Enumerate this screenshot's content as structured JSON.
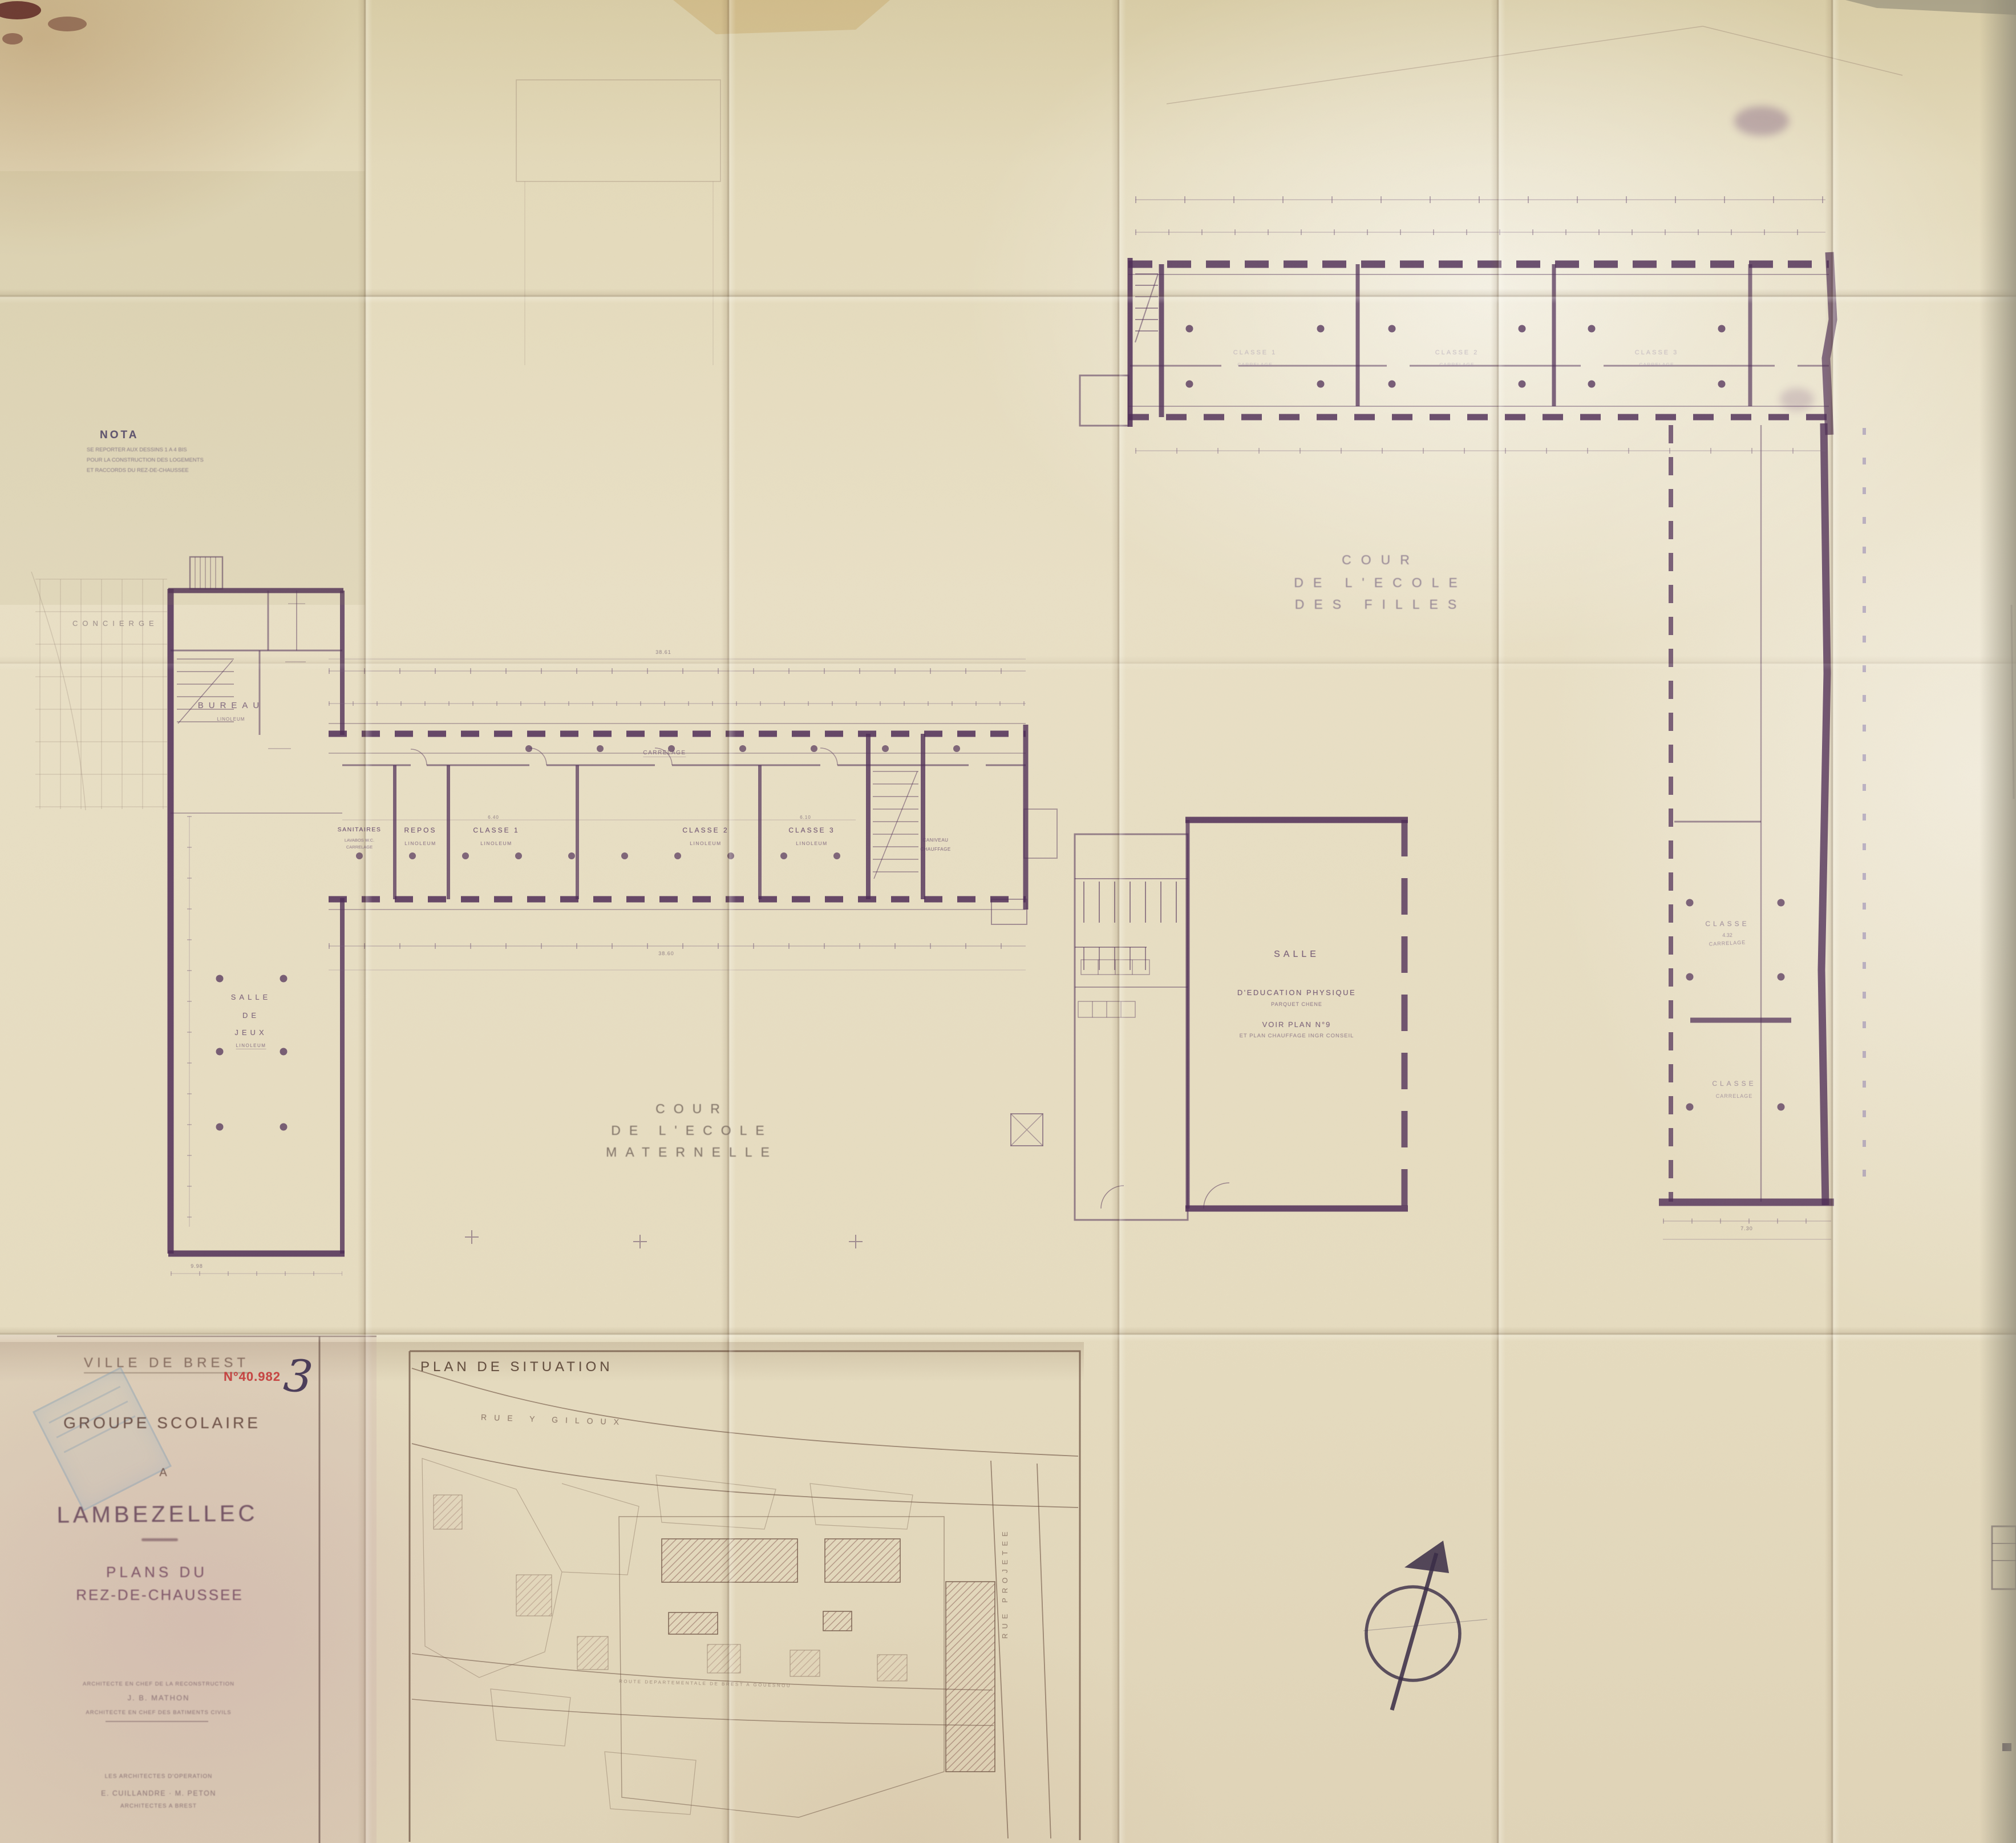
{
  "sheet": {
    "number": "3",
    "stamp": "N°40.982"
  },
  "nota": {
    "title": "NOTA",
    "line1": "SE REPORTER AUX DESSINS 1 A 4 BIS",
    "line2": "POUR LA CONSTRUCTION DES LOGEMENTS",
    "line3": "ET RACCORDS DU REZ-DE-CHAUSSEE"
  },
  "title_block": {
    "city": "VILLE DE BREST",
    "project": "GROUPE SCOLAIRE",
    "at": "A",
    "place": "LAMBEZELLEC",
    "plan1": "PLANS DU",
    "plan2": "REZ-DE-CHAUSSEE",
    "arch1a": "ARCHITECTE EN CHEF DE LA RECONSTRUCTION",
    "arch1b": "J. B. MATHON",
    "arch1c": "ARCHITECTE EN CHEF DES BATIMENTS CIVILS",
    "arch2a": "LES ARCHITECTES D'OPERATION",
    "arch2b": "E. CUILLANDRE · M. PETON",
    "arch2c": "ARCHITECTES A BREST"
  },
  "plan_labels": {
    "cour_filles_1": "COUR",
    "cour_filles_2": "DE L'ECOLE",
    "cour_filles_3": "DES FILLES",
    "cour_mat_1": "COUR",
    "cour_mat_2": "DE L'ECOLE",
    "cour_mat_3": "MATERNELLE",
    "gym_1": "SALLE",
    "gym_2": "D'EDUCATION PHYSIQUE",
    "gym_3": "PARQUET CHENE",
    "gym_4": "VOIR PLAN N°9",
    "gym_5": "ET PLAN CHAUFFAGE INGR CONSEIL",
    "jeux_1": "SALLE",
    "jeux_2": "DE",
    "jeux_3": "JEUX",
    "jeux_4": "LINOLEUM",
    "corridor": "CARRELAGE",
    "caniveau1": "CANIVEAU",
    "caniveau2": "CHAUFFAGE",
    "concierge": "CONCIERGE",
    "bureau": "BUREAU",
    "bureau_sub": "LINOLEUM"
  },
  "maternelle_rooms": [
    {
      "name": "SANITAIRES",
      "sub": "LAVABOS W.C.",
      "sub2": "CARRELAGE"
    },
    {
      "name": "REPOS",
      "sub": "LINOLEUM"
    },
    {
      "name": "CLASSE 1",
      "sub": "LINOLEUM"
    },
    {
      "name": "CLASSE 2",
      "sub": "LINOLEUM"
    },
    {
      "name": "CLASSE 3",
      "sub": "LINOLEUM"
    }
  ],
  "filles_rooms": [
    {
      "name": "CLASSE 1",
      "sub": "CARRELAGE"
    },
    {
      "name": "CLASSE 2",
      "sub": "CARRELAGE"
    },
    {
      "name": "CLASSE 3",
      "sub": "CARRELAGE"
    }
  ],
  "wing_rooms": [
    {
      "name": "CLASSE",
      "dim": "4.32",
      "sub": "CARRELAGE"
    },
    {
      "name": "CLASSE",
      "sub": "CARRELAGE"
    }
  ],
  "situation": {
    "title": "PLAN DE SITUATION",
    "street": "RUE  Y  GILOUX",
    "street2": "RUE PROJETEE",
    "road": "ROUTE DEPARTEMENTALE DE BREST A GOUESNOU"
  },
  "dims": {
    "top": "38.61",
    "bottom": "38.60",
    "a": "6.40",
    "b": "6.10",
    "left": "9.98",
    "wing": "7.30"
  }
}
